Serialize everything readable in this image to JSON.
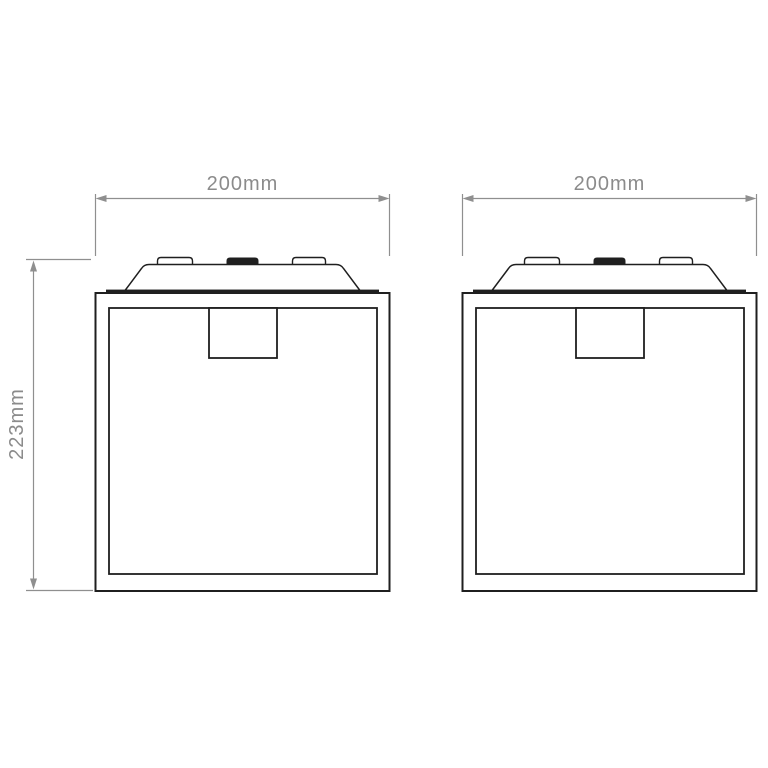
{
  "drawing": {
    "background": "#ffffff",
    "outline_color": "#1f1f1f",
    "dimension_color": "#8f8f8f",
    "left_fixture": {
      "width_label": "200mm",
      "height_label": "223mm"
    },
    "right_fixture": {
      "width_label": "200mm"
    }
  }
}
